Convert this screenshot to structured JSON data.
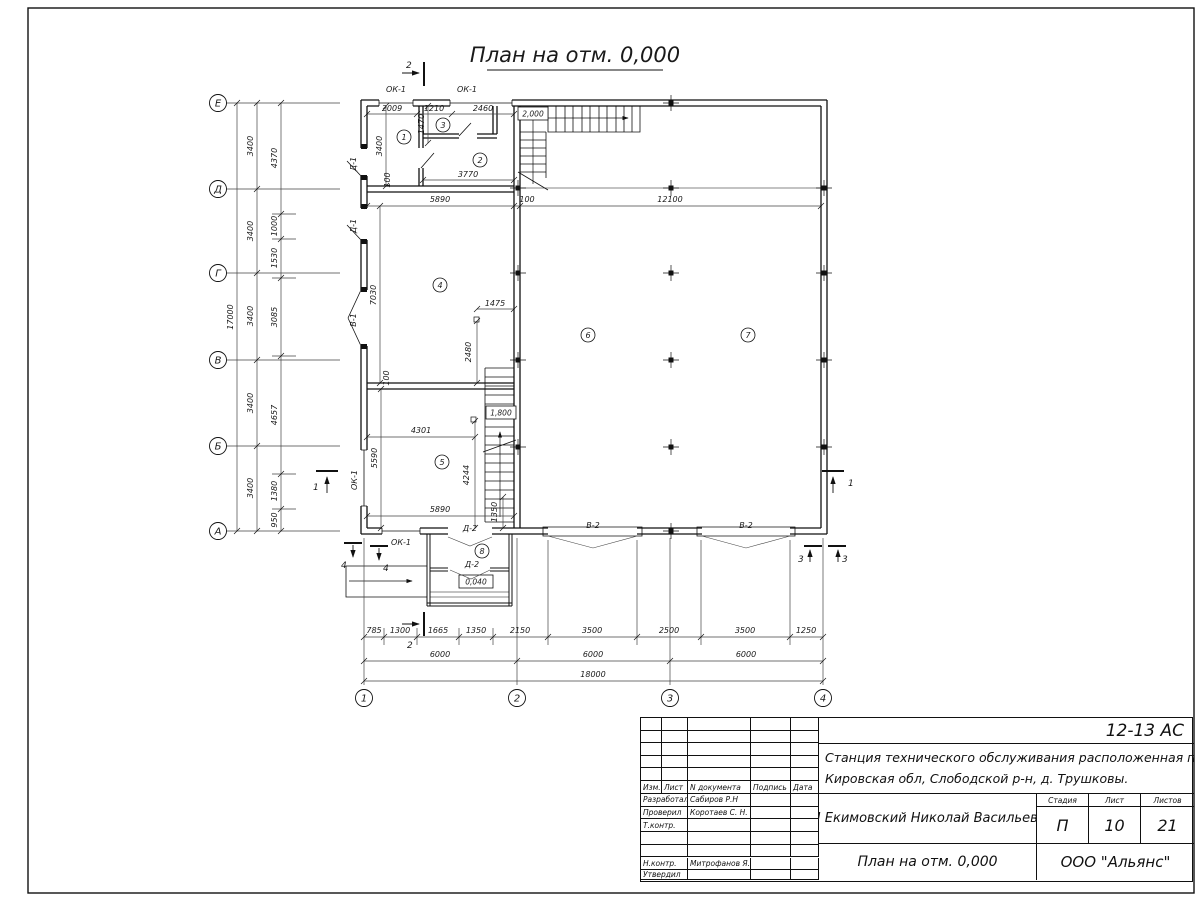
{
  "sheet": {
    "title": "План на отм. 0,000"
  },
  "plan": {
    "axes": {
      "vertical": [
        "Е",
        "Д",
        "Г",
        "В",
        "Б",
        "А"
      ],
      "horizontal": [
        "1",
        "2",
        "3",
        "4"
      ]
    },
    "rooms": [
      "1",
      "2",
      "3",
      "4",
      "5",
      "6",
      "7",
      "8"
    ],
    "openings": {
      "window": "ОК-1",
      "door1": "Д-1",
      "door2": "Д-2",
      "gate1": "В-1",
      "gate2": "В-2"
    },
    "elevations": {
      "landing": "2,000",
      "mid": "1,800",
      "porch": "0,040"
    },
    "sections": {
      "s1": "1",
      "s2": "2",
      "s3": "3",
      "s4": "4"
    },
    "dims": {
      "left_detail": [
        "4370",
        "1000",
        "1530",
        "3085",
        "4657",
        "1380",
        "950"
      ],
      "left_spans": [
        "3400",
        "3400",
        "3400",
        "3400",
        "3400"
      ],
      "left_total": "17000",
      "bottom_detail": [
        "785",
        "1300",
        "1665",
        "1350",
        "2150",
        "3500",
        "2500",
        "3500",
        "1250"
      ],
      "bottom_spans": [
        "6000",
        "6000",
        "6000"
      ],
      "bottom_total": "18000",
      "top_inner": [
        "2009",
        "1210",
        "2460"
      ],
      "mid_line": [
        "5890",
        "100",
        "12100"
      ],
      "room3_h": "1470",
      "room1_h": "3400",
      "off_top": "100",
      "room2_w": "3770",
      "room4_h": "7030",
      "drain4_x": "1475",
      "drain4_y": "2480",
      "drain5_x": "4301",
      "drain5_y": "4244",
      "room5_h": "5590",
      "off_mid": "100",
      "room5_w": "5890",
      "stair_w": "1350"
    }
  },
  "title_block": {
    "code": "12-13 АС",
    "object1": "Станция технического обслуживания расположенная по адресу",
    "object2": "Кировская обл, Слободской р-н, д. Трушковы.",
    "client": "ИП Екимовский Николай Васильевич",
    "doc_title": "План на отм. 0,000",
    "org": "ООО \"Альянс\"",
    "h_izm": "Изм.",
    "h_list": "Лист",
    "h_ndoc": "N документа",
    "h_sign": "Подпись",
    "h_date": "Дата",
    "h_stage": "Стадия",
    "h_sheet": "Лист",
    "h_sheets": "Листов",
    "stage": "П",
    "sheet": "10",
    "sheets": "21",
    "roles": [
      {
        "label": "Разработал",
        "name": "Сабиров Р.Н"
      },
      {
        "label": "Проверил",
        "name": "Коротаев С. Н."
      },
      {
        "label": "Т.контр.",
        "name": ""
      },
      {
        "label": "",
        "name": ""
      },
      {
        "label": "",
        "name": ""
      },
      {
        "label": "Н.контр.",
        "name": "Митрофанов Я. А."
      },
      {
        "label": "Утвердил",
        "name": ""
      }
    ]
  }
}
